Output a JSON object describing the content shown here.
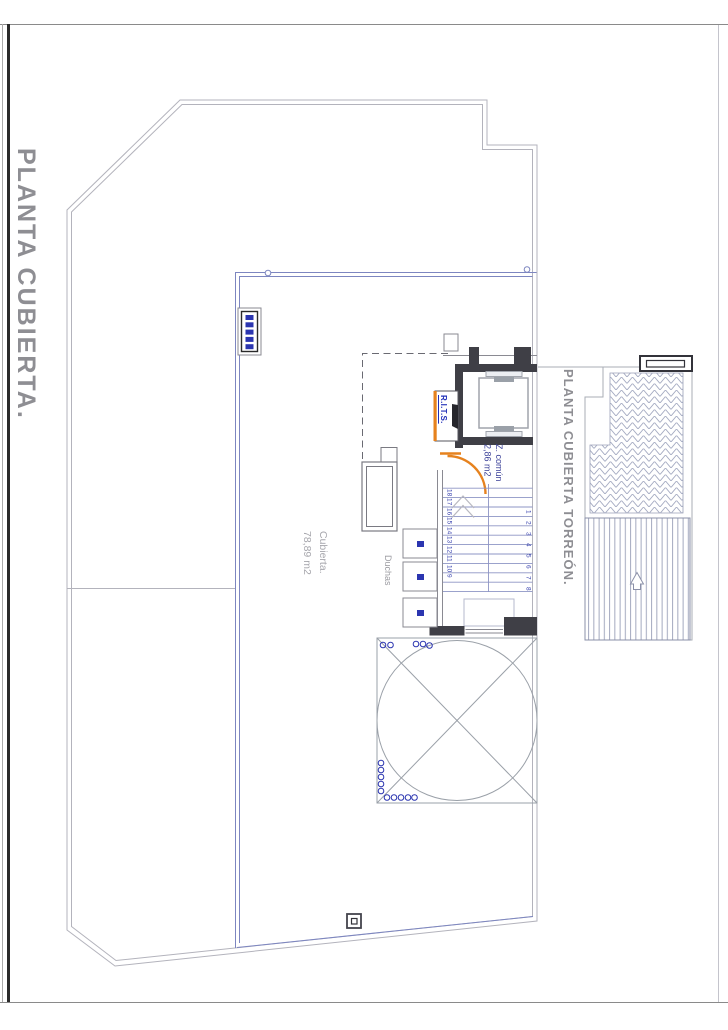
{
  "drawing": {
    "title": "PLANTA CUBIERTA.",
    "torreon_title": "PLANTA CUBIERTA TORREÓN."
  },
  "areas": {
    "cubierta": {
      "name": "Cubierta.",
      "area": "78,89 m2"
    },
    "z_comun": {
      "name": "Z. común",
      "area": "2,86 m2"
    },
    "duchas": "Duchas",
    "rits": "R.I.T.S."
  },
  "stairs": {
    "left_numbers": [
      "18",
      "17",
      "16",
      "15",
      "14",
      "13",
      "12",
      "11",
      "10",
      "9"
    ],
    "right_numbers": [
      "1",
      "2",
      "3",
      "4",
      "5",
      "6",
      "7",
      "8"
    ]
  },
  "colors": {
    "outline_gray": "#b3b3bc",
    "zone_blue": "#7d86c0",
    "stair_blue": "#8d94c4",
    "wall_dark": "#3f3f46",
    "accent_orange": "#e6821e",
    "title_gray": "#8e8e93",
    "label_blue": "#2b35b0"
  }
}
